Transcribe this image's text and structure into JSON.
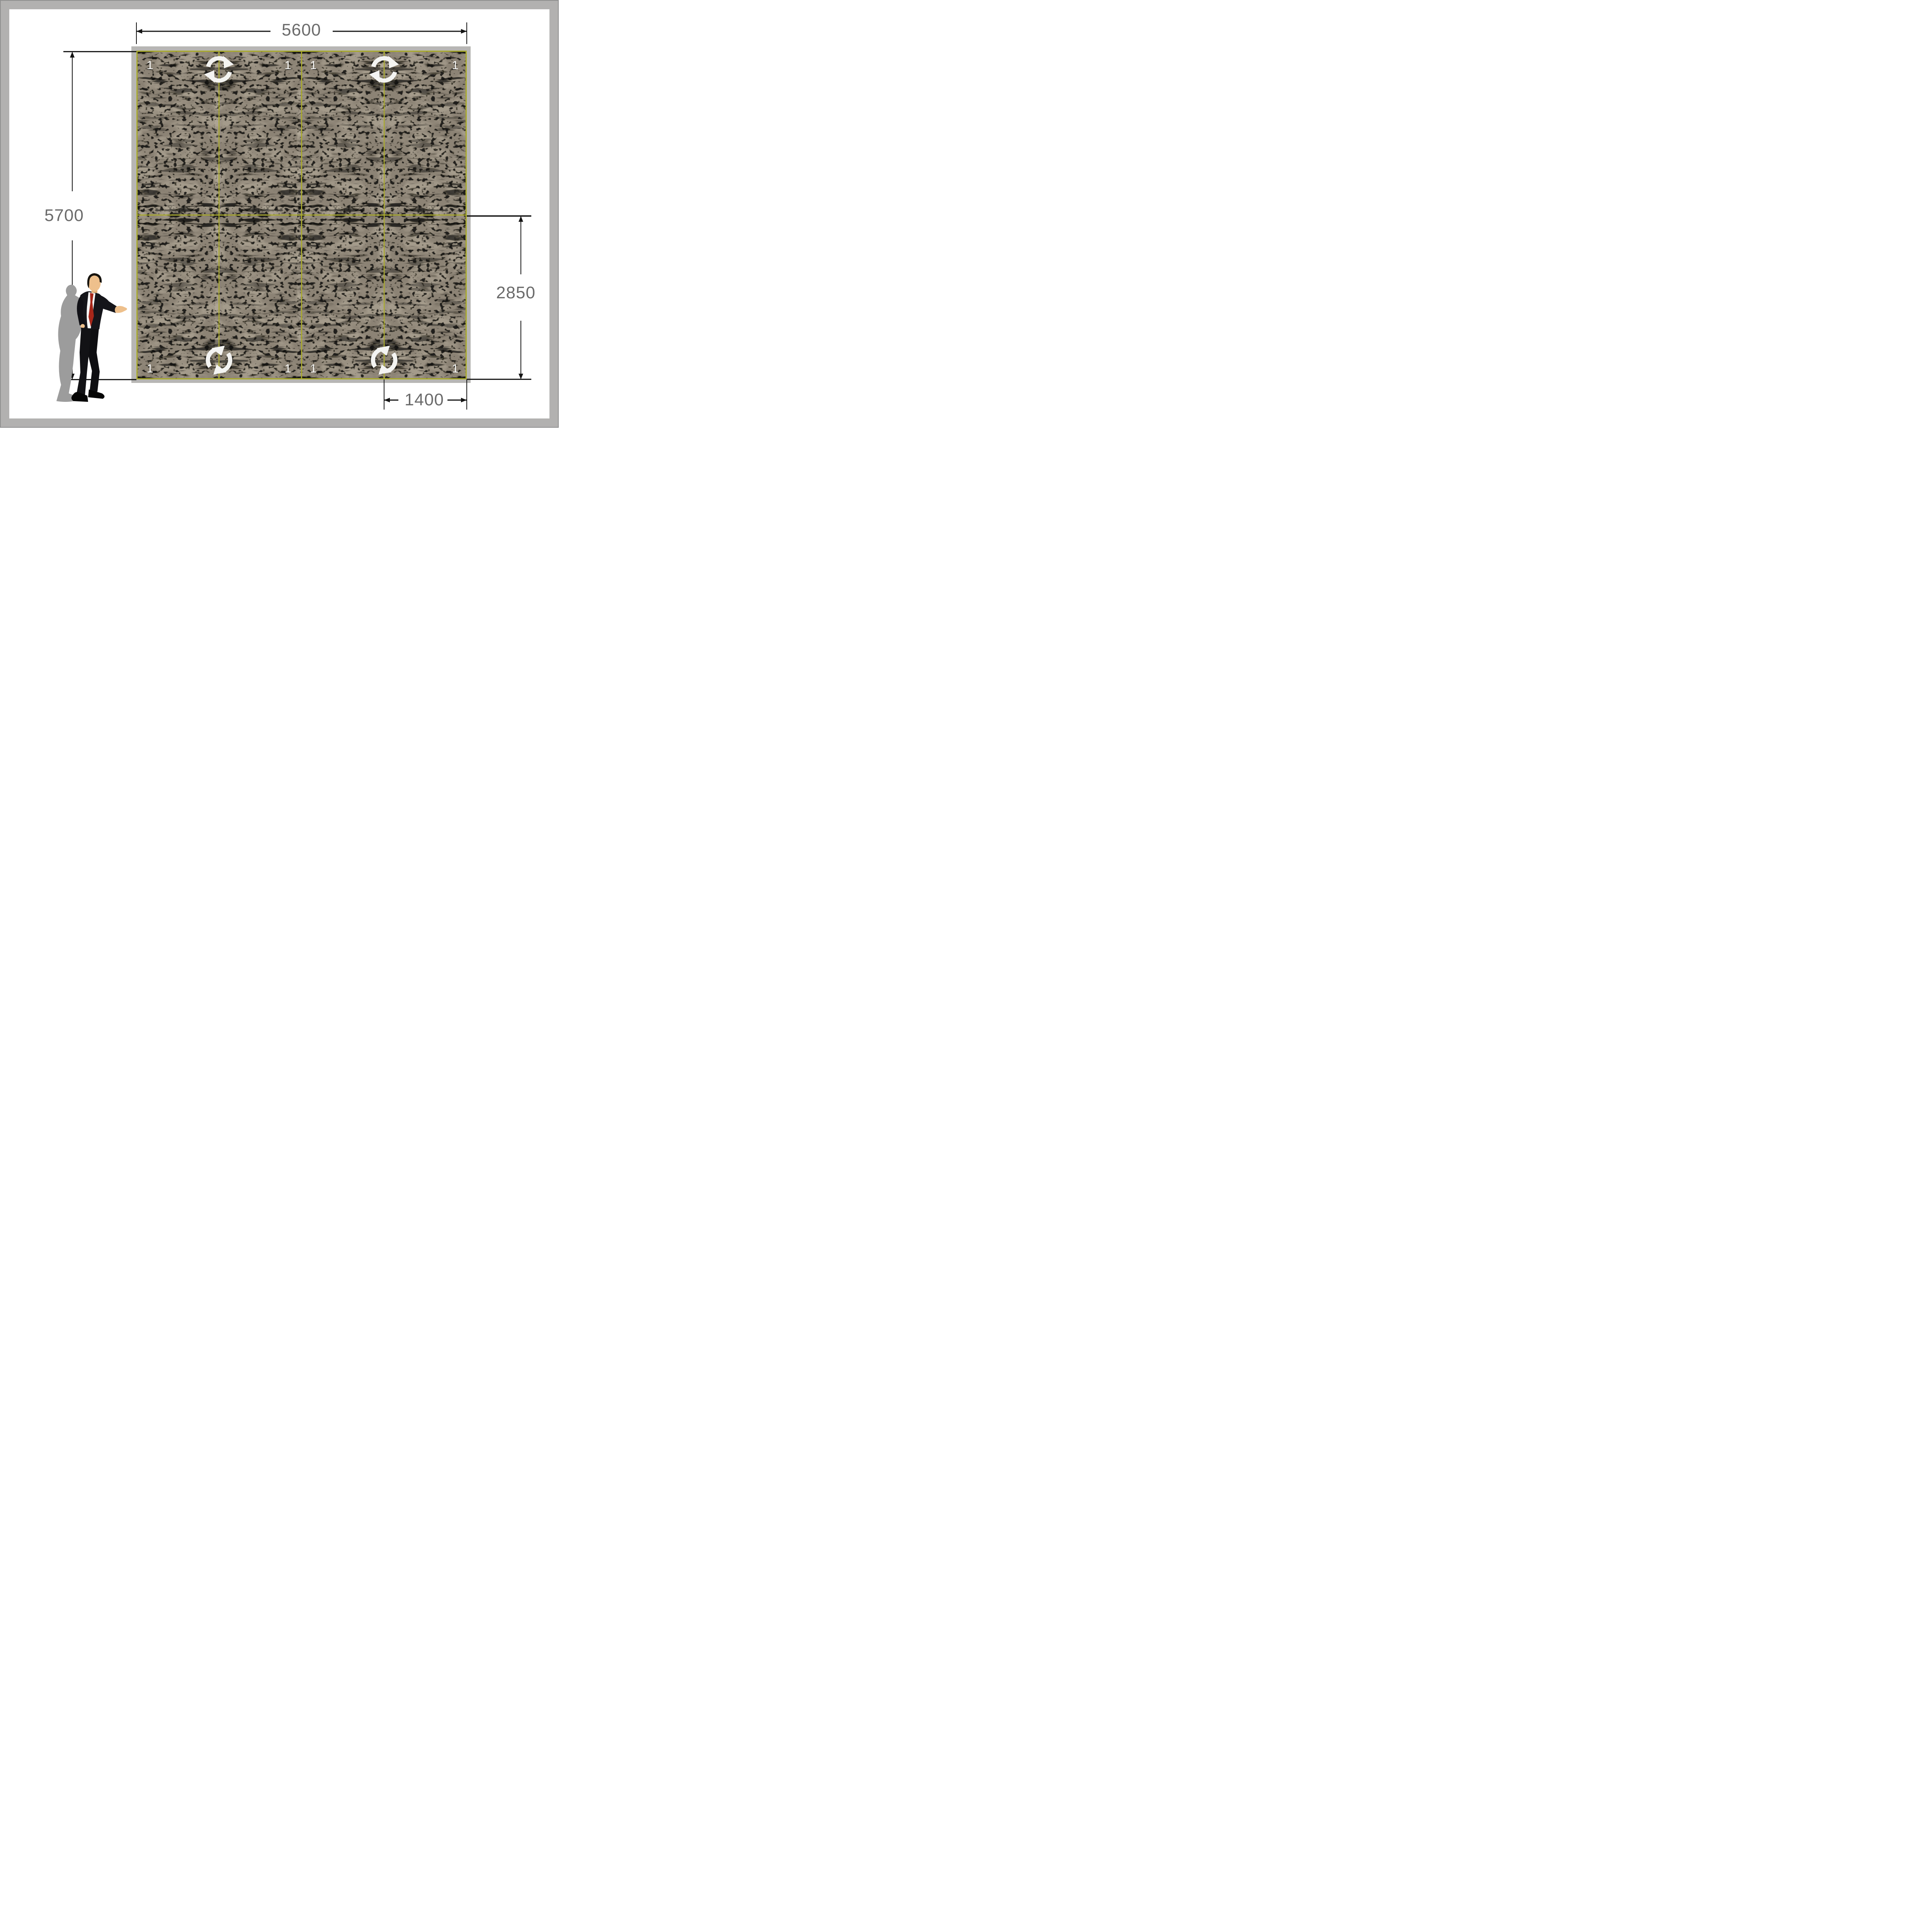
{
  "drawing": {
    "type": "panel-layout-elevation",
    "dimensions": {
      "top_width": {
        "label": "5600"
      },
      "left_height": {
        "label": "5700"
      },
      "right_height": {
        "label": "2850"
      },
      "bottom_width": {
        "label": "1400"
      }
    },
    "panel": {
      "rows": 2,
      "cols": 4,
      "cell_labels": [
        "1",
        "1",
        "1",
        "1",
        "1",
        "1",
        "1",
        "1"
      ],
      "grid_color": "#a9aa2d",
      "texture_base_color": "#8c8375",
      "texture_spot_color": "#0d0c08"
    },
    "icons": {
      "rotation_icon_count": 4,
      "rotation_icon_color": "#f4f4f2"
    },
    "scale_figure": {
      "name": "businessman",
      "suit_color": "#15151a",
      "tie_color": "#a8271a",
      "skin_color": "#eec08c",
      "shadow_color": "#9c9c9c"
    },
    "background_color": "#ffffff",
    "wall_color": "#b7b6b4",
    "frame_color": "#b2b1b0",
    "dimension_text_color": "#6b6b6b",
    "dimension_line_color": "#141414"
  }
}
